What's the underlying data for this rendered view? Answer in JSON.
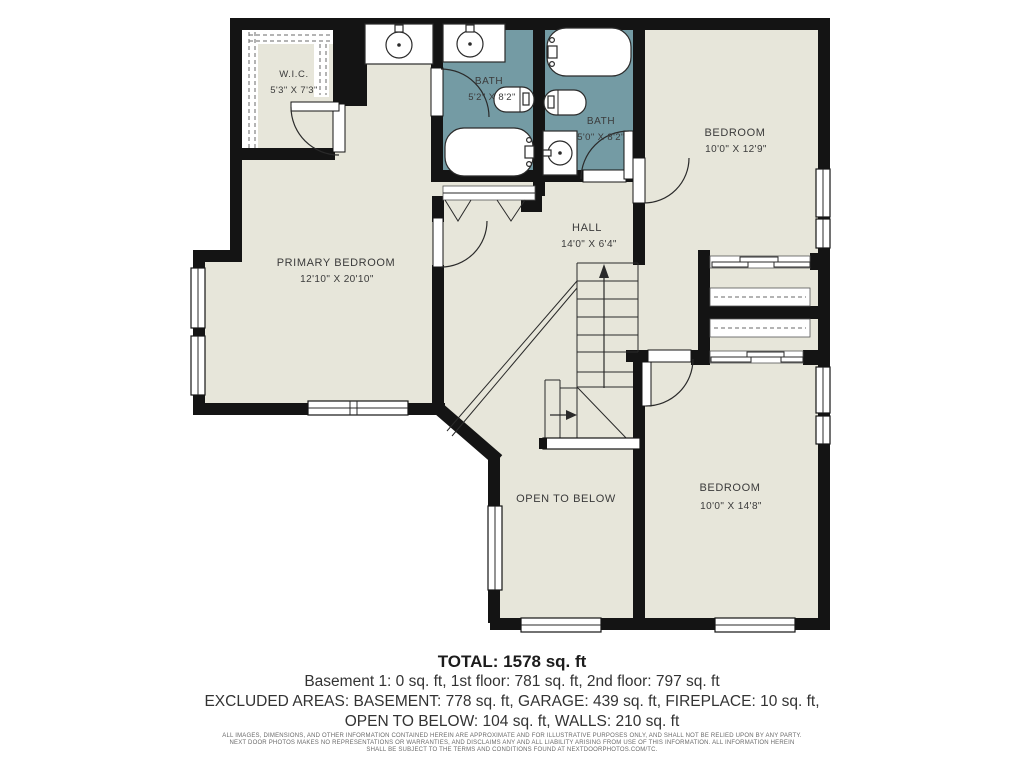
{
  "plan": {
    "title": "2nd floor plan",
    "rooms": [
      {
        "name": "W.I.C.",
        "dims": "5'3\" X 7'3\""
      },
      {
        "name": "BATH",
        "dims": "5'2\" X 8'2\""
      },
      {
        "name": "BATH",
        "dims": "5'0\" X 8'2\""
      },
      {
        "name": "BEDROOM",
        "dims": "10'0\" X 12'9\""
      },
      {
        "name": "PRIMARY BEDROOM",
        "dims": "12'10\" X 20'10\""
      },
      {
        "name": "HALL",
        "dims": "14'0\" X 6'4\""
      },
      {
        "name": "OPEN TO BELOW",
        "dims": ""
      },
      {
        "name": "BEDROOM",
        "dims": "10'0\" X 14'8\""
      }
    ],
    "colors": {
      "floor": "#e7e6da",
      "bath_floor": "#749ba4",
      "wall": "#141414",
      "label": "#3b3b3b"
    }
  },
  "summary": {
    "total": "TOTAL: 1578 sq. ft",
    "floors": "Basement 1: 0 sq. ft, 1st floor: 781 sq. ft, 2nd floor: 797 sq. ft",
    "excluded1": "EXCLUDED AREAS: BASEMENT: 778 sq. ft, GARAGE: 439 sq. ft, FIREPLACE: 10 sq. ft,",
    "excluded2": "OPEN TO BELOW: 104 sq. ft, WALLS: 210 sq. ft"
  },
  "disclaimer": {
    "line1": "ALL IMAGES, DIMENSIONS, AND OTHER INFORMATION CONTAINED HEREIN ARE APPROXIMATE AND FOR ILLUSTRATIVE PURPOSES ONLY, AND SHALL NOT BE RELIED UPON BY ANY PARTY.",
    "line2": "NEXT DOOR PHOTOS MAKES NO REPRESENTATIONS OR WARRANTIES, AND DISCLAIMS ANY AND ALL LIABILITY ARISING FROM USE OF THIS INFORMATION. ALL INFORMATION HEREIN",
    "line3": "SHALL BE SUBJECT TO THE TERMS AND CONDITIONS FOUND AT NEXTDOORPHOTOS.COM/TC."
  }
}
